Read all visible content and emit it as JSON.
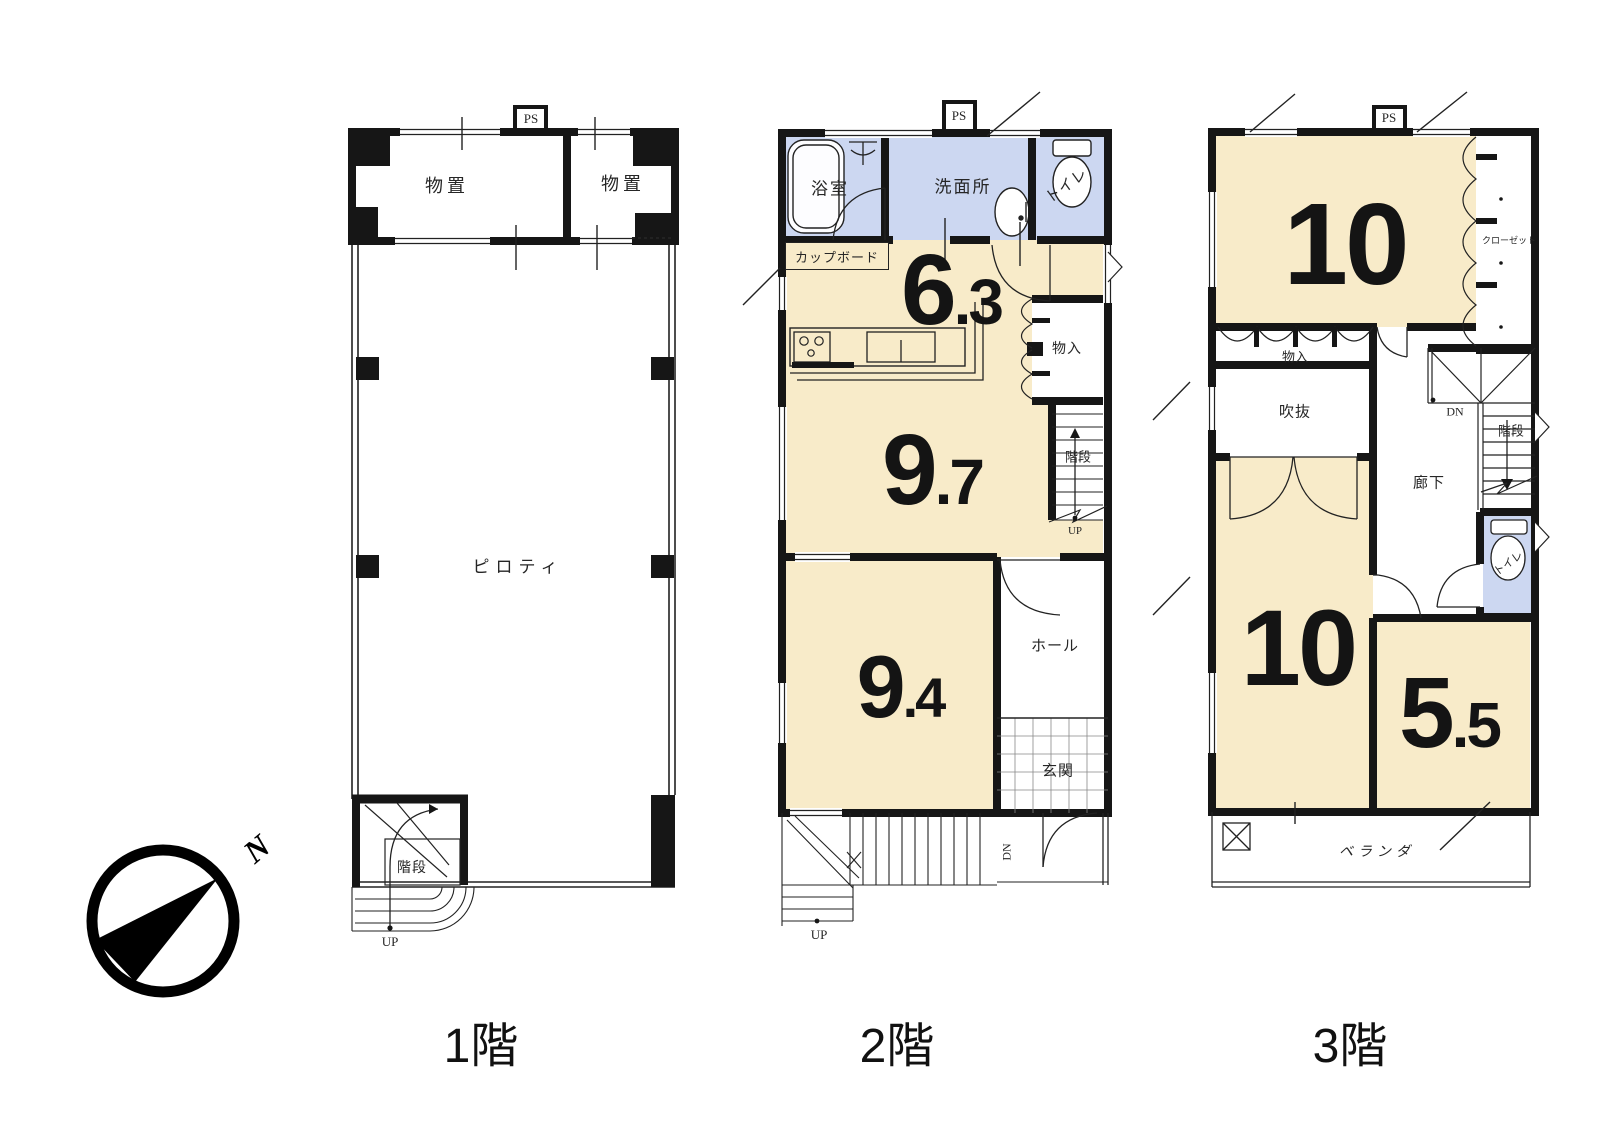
{
  "colors": {
    "wall": "#161616",
    "room_fill": "#f8ebc9",
    "wet_fill": "#ccd7f1"
  },
  "compass": {
    "north": "N"
  },
  "floors": [
    {
      "caption": "1階",
      "ps": "PS",
      "labels": {
        "storage_left": "物置",
        "storage_right": "物置",
        "piloti": "ピロティ",
        "stairs": "階段",
        "up": "UP"
      }
    },
    {
      "caption": "2階",
      "ps": "PS",
      "labels": {
        "bath": "浴室",
        "washroom": "洗面所",
        "toilet": "トイレ",
        "cupboard": "カップボード",
        "closet": "物入",
        "stairs": "階段",
        "up_stairs": "UP",
        "hall": "ホール",
        "entrance": "玄関",
        "dn": "DN",
        "up_outside": "UP"
      },
      "areas": {
        "kitchen": {
          "whole": "6",
          "decimal": ".3"
        },
        "living": {
          "whole": "9",
          "decimal": ".7"
        },
        "bedroom": {
          "whole": "9",
          "decimal": ".4"
        }
      }
    },
    {
      "caption": "3階",
      "ps": "PS",
      "labels": {
        "closet": "クローゼット",
        "storage": "物入",
        "void": "吹抜",
        "dn": "DN",
        "stairs": "階段",
        "corridor": "廊下",
        "toilet": "トイレ",
        "veranda": "ベランダ"
      },
      "areas": {
        "bedroom1": {
          "whole": "10",
          "decimal": ""
        },
        "bedroom2": {
          "whole": "10",
          "decimal": ""
        },
        "bedroom3": {
          "whole": "5",
          "decimal": ".5"
        }
      }
    }
  ]
}
